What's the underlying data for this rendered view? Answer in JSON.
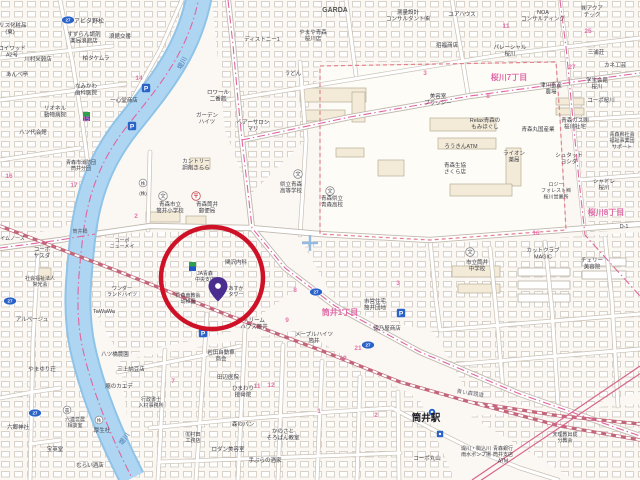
{
  "map": {
    "colors": {
      "label": "#3f3f48",
      "pink": "#e673aa",
      "district_pink": "#e06ba8",
      "river_fill": "#a9d5f0",
      "river_edge": "#8fc3e8",
      "river_text": "#4a78b0",
      "boundary_pink": "#e0649e",
      "campus_dash": "#e2808f",
      "railway": "#c2677a",
      "road_casing": "#c8c0b5",
      "blue_icon": "#2a62c8",
      "annotation_red": "#ce1126",
      "pin_purple": "#4a2d8f"
    },
    "station": {
      "name": "筒井駅",
      "railway_name": "青い森鉄道"
    },
    "river_name": "堤川",
    "annotation": {
      "circle": {
        "cx": 212,
        "cy": 278,
        "r": 51,
        "stroke": "#ce1126",
        "width": 4.5
      },
      "pin": {
        "x": 218,
        "y": 286,
        "color": "#4a2d8f"
      }
    },
    "district_labels": [
      {
        "x": 340,
        "y": 315,
        "t": "筒井1丁目"
      },
      {
        "x": 509,
        "y": 80,
        "t": "桜川7丁目"
      },
      {
        "x": 606,
        "y": 215,
        "t": "桜川8丁目"
      }
    ],
    "block_numbers": [
      {
        "x": 139,
        "y": 80,
        "t": "14"
      },
      {
        "x": 86,
        "y": 121,
        "t": "15"
      },
      {
        "x": 9,
        "y": 178,
        "t": "16"
      },
      {
        "x": 74,
        "y": 187,
        "t": "17"
      },
      {
        "x": 136,
        "y": 218,
        "t": "2"
      },
      {
        "x": 295,
        "y": 292,
        "t": "8"
      },
      {
        "x": 287,
        "y": 322,
        "t": "9"
      },
      {
        "x": 343,
        "y": 360,
        "t": "10"
      },
      {
        "x": 358,
        "y": 350,
        "t": "21"
      },
      {
        "x": 173,
        "y": 383,
        "t": "7"
      },
      {
        "x": 257,
        "y": 388,
        "t": "11"
      },
      {
        "x": 271,
        "y": 387,
        "t": "12"
      },
      {
        "x": 319,
        "y": 413,
        "t": "1"
      },
      {
        "x": 376,
        "y": 417,
        "t": "2"
      },
      {
        "x": 398,
        "y": 285,
        "t": "3"
      },
      {
        "x": 425,
        "y": 75,
        "t": "3"
      },
      {
        "x": 506,
        "y": 28,
        "t": "11"
      },
      {
        "x": 588,
        "y": 33,
        "t": "25"
      },
      {
        "x": 572,
        "y": 69,
        "t": "27"
      },
      {
        "x": 488,
        "y": 98,
        "t": "8"
      },
      {
        "x": 536,
        "y": 235,
        "t": "16"
      }
    ],
    "road_badges": [
      {
        "x": 68,
        "y": 20,
        "t": "27"
      },
      {
        "x": 10,
        "y": 301,
        "t": "27"
      },
      {
        "x": 35,
        "y": 413,
        "t": "27"
      },
      {
        "x": 316,
        "y": 292,
        "t": "27"
      },
      {
        "x": 368,
        "y": 345,
        "t": "27"
      }
    ],
    "parking_icons": [
      {
        "x": 146,
        "y": 88
      },
      {
        "x": 132,
        "y": 126
      },
      {
        "x": 203,
        "y": 333
      },
      {
        "x": 401,
        "y": 313
      }
    ],
    "school_icons": [
      {
        "x": 163,
        "y": 196
      },
      {
        "x": 298,
        "y": 174
      },
      {
        "x": 330,
        "y": 191
      },
      {
        "x": 470,
        "y": 252
      }
    ],
    "post_icons": [
      {
        "x": 196,
        "y": 196
      }
    ],
    "circled_marks": [
      {
        "x": 143,
        "y": 183,
        "t": "株"
      },
      {
        "x": 67,
        "y": 410,
        "t": "農"
      },
      {
        "x": 99,
        "y": 420,
        "t": "株"
      }
    ],
    "store_signs": [
      {
        "x": 83,
        "y": 112
      },
      {
        "x": 189,
        "y": 262
      }
    ],
    "station_icon": {
      "x": 432,
      "y": 412
    },
    "mini_blue_square": {
      "x": 440,
      "y": 434
    },
    "grid_cross": {
      "x": 310,
      "y": 243
    },
    "labels": [
      {
        "x": 89,
        "y": 23,
        "lines": [
          "アビタ野松"
        ]
      },
      {
        "x": 84,
        "y": 36,
        "s": 5.5,
        "lines": [
          "すずらん調剤",
          "薬局浪館店"
        ]
      },
      {
        "x": 10,
        "y": 27,
        "s": 5.5,
        "lines": [
          "ナリス化粧品",
          "(東)"
        ]
      },
      {
        "x": 12,
        "y": 50,
        "s": 5.5,
        "lines": [
          "コイワッド",
          "A2号"
        ]
      },
      {
        "x": 17,
        "y": 76,
        "s": 5.5,
        "lines": [
          "あんべ亭"
        ]
      },
      {
        "x": 55,
        "y": 110,
        "s": 5.5,
        "lines": [
          "リオネル",
          "動物病院"
        ]
      },
      {
        "x": 33,
        "y": 134,
        "s": 5.5,
        "lines": [
          "八ツ代会館"
        ]
      },
      {
        "x": 38,
        "y": 61,
        "s": 5.5,
        "lines": [
          "川村米穀店"
        ]
      },
      {
        "x": 96,
        "y": 60,
        "s": 5.5,
        "lines": [
          "柏タケムラ"
        ]
      },
      {
        "x": 120,
        "y": 38,
        "s": 5.5,
        "lines": [
          "浪館交番"
        ]
      },
      {
        "x": 86,
        "y": 88,
        "s": 5.5,
        "lines": [
          "なみかわ",
          "歯科医院"
        ]
      },
      {
        "x": 124,
        "y": 102,
        "s": 5.5,
        "lines": [
          "一心堂商店"
        ]
      },
      {
        "x": 170,
        "y": 206,
        "s": 5.5,
        "lines": [
          "青森市立",
          "筒井小学校"
        ]
      },
      {
        "x": 207,
        "y": 206,
        "s": 5.5,
        "lines": [
          "青森筒井",
          "郵便局"
        ]
      },
      {
        "x": 196,
        "y": 163,
        "s": 5.5,
        "lines": [
          "カントリー",
          "調剤きらら"
        ]
      },
      {
        "x": 143,
        "y": 195,
        "s": 4.5,
        "lines": [
          "(株)"
        ]
      },
      {
        "x": 218,
        "y": 94,
        "s": 5.5,
        "lines": [
          "ロワール",
          "二番館"
        ]
      },
      {
        "x": 207,
        "y": 117,
        "s": 5.5,
        "lines": [
          "ガーデン",
          "ハイツ"
        ]
      },
      {
        "x": 253,
        "y": 124,
        "s": 5.5,
        "lines": [
          "ヘアーサロン",
          "マリ"
        ]
      },
      {
        "x": 262,
        "y": 41,
        "s": 5.5,
        "lines": [
          "ディストニー1"
        ]
      },
      {
        "x": 313,
        "y": 34,
        "s": 5.5,
        "lines": [
          "やまや青森",
          "桜川店"
        ]
      },
      {
        "x": 293,
        "y": 75,
        "s": 5.5,
        "lines": [
          "うどん"
        ]
      },
      {
        "x": 335,
        "y": 12,
        "s": 7,
        "b": 1,
        "c": "#555555",
        "lines": [
          "GARDA"
        ]
      },
      {
        "x": 408,
        "y": 14,
        "s": 5.5,
        "lines": [
          "測量設計",
          "コンサルタント㈱"
        ]
      },
      {
        "x": 543,
        "y": 14,
        "s": 5.5,
        "lines": [
          "NOA",
          "コンサルティング"
        ]
      },
      {
        "x": 462,
        "y": 16,
        "s": 5.5,
        "lines": [
          "ユアハウス"
        ]
      },
      {
        "x": 592,
        "y": 10,
        "s": 5.5,
        "lines": [
          "㈱アクア",
          "テック"
        ]
      },
      {
        "x": 510,
        "y": 49,
        "s": 5.5,
        "lines": [
          "パレーシャル",
          "桜川"
        ]
      },
      {
        "x": 596,
        "y": 54,
        "s": 5.5,
        "lines": [
          "三浦荘"
        ]
      },
      {
        "x": 615,
        "y": 67,
        "s": 5.5,
        "lines": [
          "カネ工芸"
        ]
      },
      {
        "x": 597,
        "y": 82,
        "s": 5.5,
        "lines": [
          "学生会館",
          "桜川"
        ]
      },
      {
        "x": 601,
        "y": 102,
        "s": 5.5,
        "lines": [
          "コーポ桜川"
        ]
      },
      {
        "x": 447,
        "y": 47,
        "s": 5.5,
        "lines": [
          "招福商店"
        ]
      },
      {
        "x": 551,
        "y": 87,
        "s": 5.5,
        "lines": [
          "津川畜産",
          "農場"
        ]
      },
      {
        "x": 622,
        "y": 136,
        "s": 5,
        "lines": [
          "青森県社会",
          "福祉事業団",
          "サポート"
        ]
      },
      {
        "x": 538,
        "y": 131,
        "s": 5.5,
        "lines": [
          "青森丸国産業"
        ]
      },
      {
        "x": 575,
        "y": 122,
        "s": 5.5,
        "lines": [
          "青森ガス㈱",
          "桜川社宅"
        ]
      },
      {
        "x": 485,
        "y": 122,
        "s": 5.5,
        "lines": [
          "Relax青森の",
          "もみほぐし"
        ]
      },
      {
        "x": 438,
        "y": 98,
        "s": 5.5,
        "lines": [
          "美容室",
          "ブラッシー"
        ]
      },
      {
        "x": 461,
        "y": 148,
        "s": 5.5,
        "lines": [
          "ろうきんATM"
        ]
      },
      {
        "x": 455,
        "y": 167,
        "s": 5.5,
        "lines": [
          "青森生協",
          "さくら店"
        ]
      },
      {
        "x": 514,
        "y": 155,
        "s": 5.5,
        "lines": [
          "ライオン",
          "薬局"
        ]
      },
      {
        "x": 569,
        "y": 157,
        "s": 5.5,
        "lines": [
          "シュタット",
          "ヨシダ"
        ]
      },
      {
        "x": 556,
        "y": 186,
        "s": 5,
        "lines": [
          "ロジー",
          "フォレスト㈱",
          "桜川営業所"
        ]
      },
      {
        "x": 604,
        "y": 183,
        "s": 5.5,
        "lines": [
          "シャドレ",
          "桜川"
        ]
      },
      {
        "x": 624,
        "y": 228,
        "s": 5.5,
        "lines": [
          "D-1"
        ]
      },
      {
        "x": 543,
        "y": 252,
        "s": 5.5,
        "lines": [
          "カットクラブ",
          "MAGIC"
        ]
      },
      {
        "x": 592,
        "y": 262,
        "s": 5.5,
        "lines": [
          "チェリー",
          "美容院"
        ]
      },
      {
        "x": 477,
        "y": 264,
        "s": 5.5,
        "lines": [
          "市立筒井",
          "中学校"
        ]
      },
      {
        "x": 291,
        "y": 186,
        "s": 5.5,
        "lines": [
          "県立青森",
          "高等学校"
        ]
      },
      {
        "x": 332,
        "y": 200,
        "s": 5.5,
        "lines": [
          "青森県立",
          "青森高校"
        ]
      },
      {
        "x": 236,
        "y": 264,
        "s": 5.5,
        "lines": [
          "関沢内科"
        ]
      },
      {
        "x": 205,
        "y": 275,
        "s": 5,
        "lines": [
          "JA青森",
          "中央支店"
        ]
      },
      {
        "x": 188,
        "y": 297,
        "s": 5,
        "lines": [
          "青森南教会",
          "幼稚園"
        ]
      },
      {
        "x": 236,
        "y": 290,
        "s": 5,
        "lines": [
          "あすか",
          "タワー"
        ]
      },
      {
        "x": 254,
        "y": 322,
        "s": 5.5,
        "lines": [
          "ドリーム",
          "ハウス筒井"
        ]
      },
      {
        "x": 221,
        "y": 354,
        "s": 5.5,
        "lines": [
          "岩田自動車",
          "商会"
        ]
      },
      {
        "x": 228,
        "y": 379,
        "s": 5.5,
        "lines": [
          "田辺医院"
        ]
      },
      {
        "x": 243,
        "y": 390,
        "s": 5.5,
        "lines": [
          "ひまわり",
          "接骨院"
        ]
      },
      {
        "x": 314,
        "y": 336,
        "s": 5.5,
        "lines": [
          "メープルハイツ",
          "筒井"
        ]
      },
      {
        "x": 375,
        "y": 303,
        "s": 5.5,
        "lines": [
          "市営住宅",
          "筒井団地"
        ]
      },
      {
        "x": 387,
        "y": 330,
        "s": 5.5,
        "lines": [
          "徳乃屋商店"
        ]
      },
      {
        "x": 426,
        "y": 421,
        "s": 9.5,
        "b": 1,
        "c": "#1c1c24",
        "n": "station-name-label",
        "lines": [
          "筒井駅"
        ]
      },
      {
        "x": 470,
        "y": 395,
        "s": 5.5,
        "c": "#6b6b74",
        "r": 9,
        "n": "railway-name-label",
        "lines": [
          "青い森鉄道"
        ]
      },
      {
        "x": 476,
        "y": 450,
        "s": 5,
        "lines": [
          "堤川・駒込川",
          "雨水ポンプ場"
        ]
      },
      {
        "x": 565,
        "y": 436,
        "s": 5,
        "lines": [
          "天理教出成",
          "分教会"
        ]
      },
      {
        "x": 503,
        "y": 450,
        "s": 5,
        "lines": [
          "青森銀行",
          "筒井支店",
          "ATM"
        ]
      },
      {
        "x": 427,
        "y": 460,
        "s": 5.5,
        "lines": [
          "コーポ丸山"
        ]
      },
      {
        "x": 42,
        "y": 371,
        "s": 5.5,
        "lines": [
          "やまゆり荘"
        ]
      },
      {
        "x": 75,
        "y": 421,
        "s": 5,
        "lines": [
          "六連営農",
          "相談室"
        ]
      },
      {
        "x": 102,
        "y": 432,
        "s": 5.5,
        "lines": [
          "厚生社"
        ]
      },
      {
        "x": 131,
        "y": 371,
        "s": 5.5,
        "lines": [
          "三上納豆店"
        ]
      },
      {
        "x": 119,
        "y": 388,
        "s": 5.5,
        "lines": [
          "庵のカエデ"
        ]
      },
      {
        "x": 151,
        "y": 401,
        "s": 5,
        "lines": [
          "行政書士",
          "入村事務所"
        ]
      },
      {
        "x": 115,
        "y": 356,
        "s": 5.5,
        "lines": [
          "八ツ橋農園"
        ]
      },
      {
        "x": 18,
        "y": 429,
        "s": 5.5,
        "lines": [
          "六郷神社"
        ]
      },
      {
        "x": 55,
        "y": 451,
        "s": 5.5,
        "lines": [
          "宝英堂"
        ]
      },
      {
        "x": 90,
        "y": 467,
        "s": 5.5,
        "lines": [
          "むらい酒店"
        ]
      },
      {
        "x": 193,
        "y": 436,
        "s": 5,
        "lines": [
          "㈲村田",
          "工務店"
        ]
      },
      {
        "x": 228,
        "y": 451,
        "s": 5.5,
        "lines": [
          "ロダン美容室"
        ]
      },
      {
        "x": 265,
        "y": 462,
        "s": 5.5,
        "lines": [
          "手ぶらの酒家"
        ]
      },
      {
        "x": 283,
        "y": 433,
        "s": 5.5,
        "lines": [
          "かのさと",
          "そろばん教室"
        ]
      },
      {
        "x": 243,
        "y": 426,
        "s": 5.5,
        "lines": [
          "森のパン"
        ]
      },
      {
        "x": 81,
        "y": 164,
        "s": 5,
        "lines": [
          "青森市消防団",
          "筒井分団"
        ]
      },
      {
        "x": 80,
        "y": 233,
        "s": 5,
        "c": "#5a5a64",
        "lines": [
          "筒井橋"
        ]
      },
      {
        "x": 10,
        "y": 240,
        "s": 5,
        "lines": [
          "ハイムノース"
        ]
      },
      {
        "x": 42,
        "y": 251,
        "s": 5.5,
        "lines": [
          "コーポ",
          "ヤスダ"
        ]
      },
      {
        "x": 40,
        "y": 280,
        "s": 5,
        "lines": [
          "社会福祉法人",
          "常光会"
        ]
      },
      {
        "x": 122,
        "y": 290,
        "s": 5,
        "lines": [
          "ワンダー",
          "ランドハイツ"
        ]
      },
      {
        "x": 104,
        "y": 313,
        "s": 5.5,
        "lines": [
          "TaWaWa"
        ]
      },
      {
        "x": 32,
        "y": 321,
        "s": 5.5,
        "lines": [
          "アルページュ"
        ]
      },
      {
        "x": 122,
        "y": 242,
        "s": 5,
        "lines": [
          "コーポ",
          "ニューメイ"
        ]
      },
      {
        "x": 184,
        "y": 64,
        "s": 6.5,
        "c": "#4a78b0",
        "r": -62,
        "n": "river-name-label",
        "lines": [
          "堤川"
        ]
      },
      {
        "x": 126,
        "y": 440,
        "s": 6.5,
        "c": "#4a78b0",
        "r": -55,
        "n": "river-name-label",
        "lines": [
          "堤川"
        ]
      }
    ]
  }
}
